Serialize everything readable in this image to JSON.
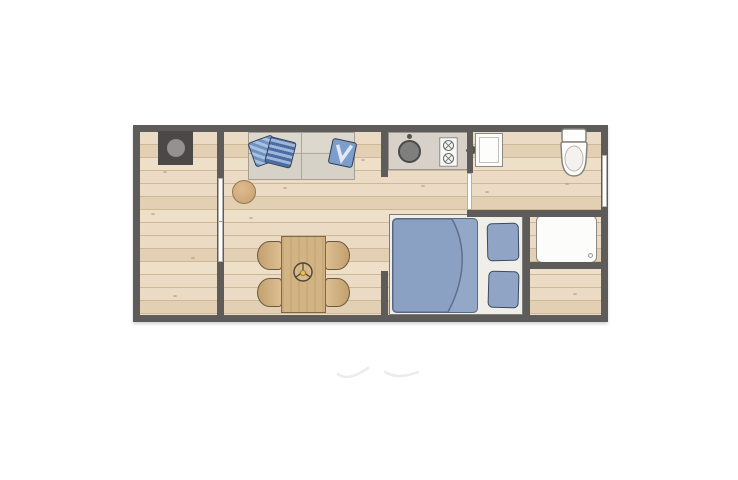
{
  "scene": {
    "type": "floor-plan",
    "subject": "Top-down architectural floor plan of a small rectangular studio cabin",
    "background": "#ffffff"
  },
  "palette": {
    "wall": "#5d5c5a",
    "floor_plank": "#ebdbc4",
    "floor_plank_dark": "#e2cfb4",
    "floor_plank_line": "#cfb896",
    "wood_furniture": "#d2b384",
    "wood_border": "#7c6845",
    "sofa_fabric": "#d6d2c7",
    "sofa_border": "#a49e93",
    "textile_blue": "#8ba1c4",
    "textile_border": "#5a6885",
    "cushion_blue": "#7d9ecb",
    "cushion_border": "#2e3d55",
    "counter": "#d7d1c9",
    "fixture_white": "#fcfcfa",
    "fixture_border": "#8b8984",
    "stove_black": "#4a4947",
    "stove_plate": "#949190",
    "sink_basin": "#7f7f7d",
    "window_white": "#ffffff",
    "watermark_gray": "#ebebeb"
  },
  "rooms": [
    {
      "id": "side-room",
      "label": "side room with wood stove"
    },
    {
      "id": "living-dining",
      "label": "living and dining area"
    },
    {
      "id": "kitchenette",
      "label": "kitchenette"
    },
    {
      "id": "bathroom",
      "label": "bathroom with toilet and basin"
    },
    {
      "id": "sleeping-area",
      "label": "sleeping area"
    },
    {
      "id": "storage-nook",
      "label": "storage nook below shower"
    }
  ],
  "furniture": [
    {
      "id": "wood-stove",
      "label": "wood stove with round top plate"
    },
    {
      "id": "sofa",
      "label": "two-seat sofa",
      "cushions": 3
    },
    {
      "id": "side-table",
      "label": "round side table"
    },
    {
      "id": "dining-table",
      "label": "dining table with centerpiece"
    },
    {
      "id": "dining-chair",
      "label": "dining chair",
      "count": 4
    },
    {
      "id": "kitchen-counter",
      "label": "counter with round sink and hob",
      "burners": 2
    },
    {
      "id": "wash-basin",
      "label": "wash basin with tap"
    },
    {
      "id": "toilet",
      "label": "toilet"
    },
    {
      "id": "shower",
      "label": "shower tray with drain"
    },
    {
      "id": "double-bed",
      "label": "bed with blue duvet",
      "pillows": 2
    }
  ],
  "openings": [
    {
      "id": "sliding-door-interior",
      "label": "sliding door in interior partition wall"
    },
    {
      "id": "pocket-door-bathroom",
      "label": "pocket door beside kitchenette"
    },
    {
      "id": "window-right",
      "label": "window in right exterior wall"
    }
  ]
}
